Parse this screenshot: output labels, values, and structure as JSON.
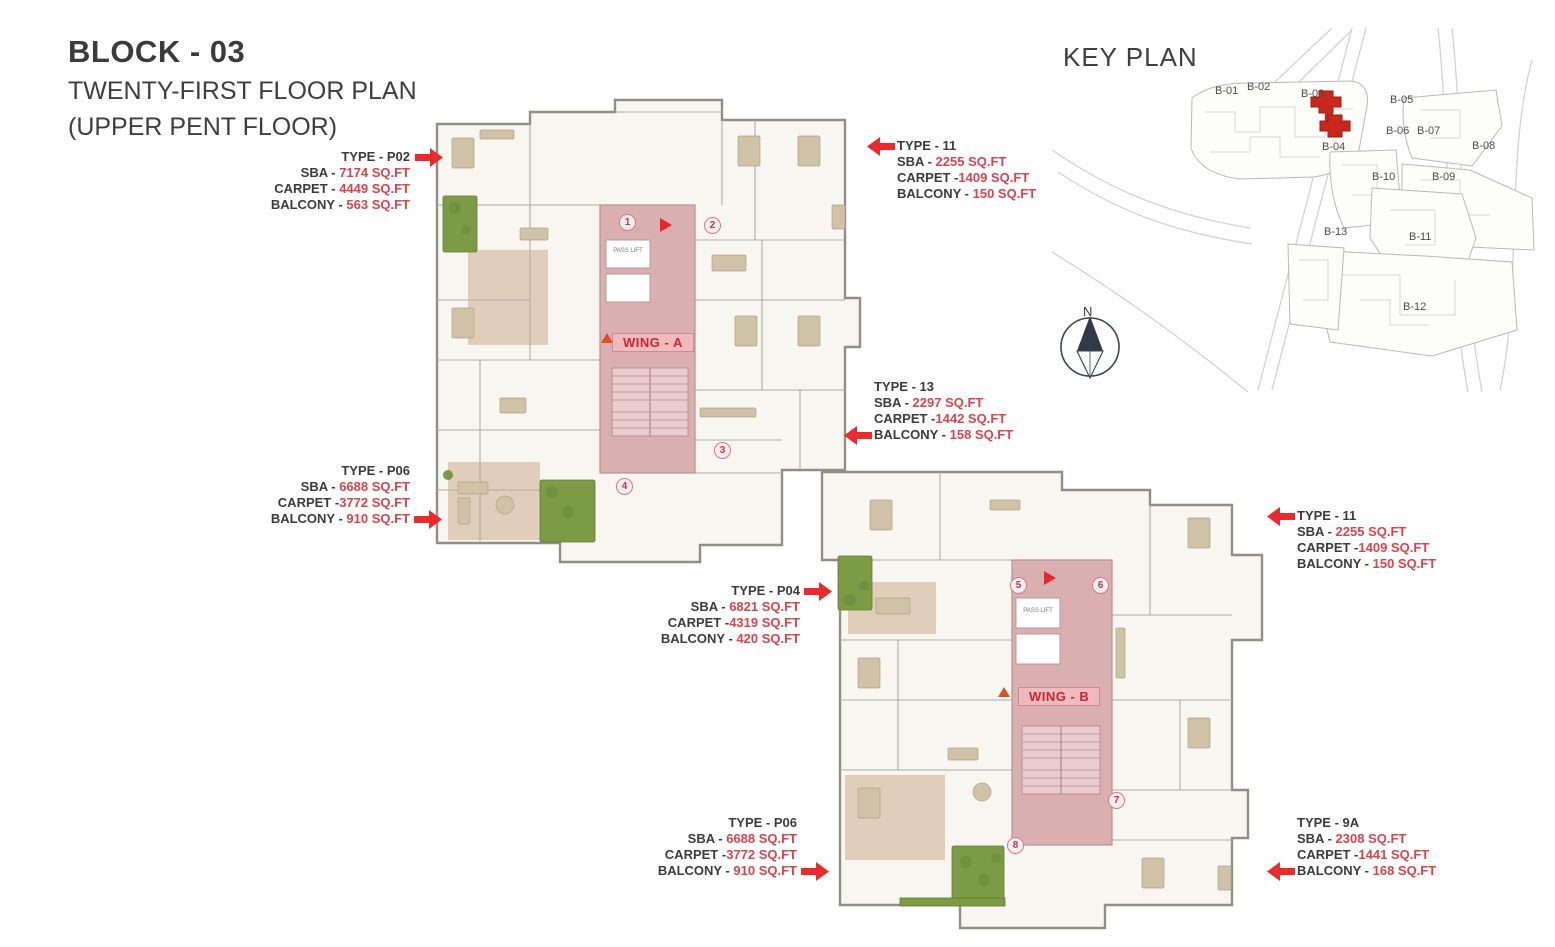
{
  "page_title": {
    "block": "BLOCK - 03",
    "plan": "TWENTY-FIRST FLOOR PLAN",
    "sub": "(UPPER PENT FLOOR)"
  },
  "key_plan": {
    "title": "KEY PLAN",
    "north_label": "N",
    "highlighted_block": "B-03",
    "blocks": [
      "B-01",
      "B-02",
      "B-03",
      "B-04",
      "B-05",
      "B-06",
      "B-07",
      "B-08",
      "B-09",
      "B-10",
      "B-11",
      "B-12",
      "B-13"
    ]
  },
  "wings": [
    {
      "label": "WING - A"
    },
    {
      "label": "WING - B"
    }
  ],
  "unit_markers": [
    "1",
    "2",
    "3",
    "4",
    "5",
    "6",
    "7",
    "8"
  ],
  "plan_labels": {
    "lift": "PASS LIFT"
  },
  "annotations": [
    {
      "name": "TYPE - P02",
      "arrow": "right",
      "rows": [
        {
          "label": "SBA - ",
          "value": "7174 SQ.FT"
        },
        {
          "label": "CARPET - ",
          "value": "4449 SQ.FT"
        },
        {
          "label": "BALCONY - ",
          "value": "563 SQ.FT"
        }
      ]
    },
    {
      "name": "TYPE - 11",
      "arrow": "left",
      "rows": [
        {
          "label": "SBA - ",
          "value": "2255 SQ.FT"
        },
        {
          "label": "CARPET -",
          "value": "1409 SQ.FT"
        },
        {
          "label": "BALCONY - ",
          "value": "150 SQ.FT"
        }
      ]
    },
    {
      "name": "TYPE - 13",
      "arrow": "left",
      "rows": [
        {
          "label": "SBA - ",
          "value": "2297 SQ.FT"
        },
        {
          "label": "CARPET -",
          "value": "1442 SQ.FT"
        },
        {
          "label": "BALCONY - ",
          "value": "158 SQ.FT"
        }
      ]
    },
    {
      "name": "TYPE - P06",
      "arrow": "right",
      "rows": [
        {
          "label": "SBA - ",
          "value": "6688 SQ.FT"
        },
        {
          "label": "CARPET -",
          "value": "3772 SQ.FT"
        },
        {
          "label": "BALCONY - ",
          "value": "910 SQ.FT"
        }
      ]
    },
    {
      "name": "TYPE - 11",
      "arrow": "left",
      "rows": [
        {
          "label": "SBA - ",
          "value": "2255 SQ.FT"
        },
        {
          "label": "CARPET -",
          "value": "1409 SQ.FT"
        },
        {
          "label": "BALCONY - ",
          "value": "150 SQ.FT"
        }
      ]
    },
    {
      "name": "TYPE - P04",
      "arrow": "right",
      "rows": [
        {
          "label": "SBA - ",
          "value": "6821 SQ.FT"
        },
        {
          "label": "CARPET -",
          "value": "4319 SQ.FT"
        },
        {
          "label": "BALCONY - ",
          "value": "420 SQ.FT"
        }
      ]
    },
    {
      "name": "TYPE - P06",
      "arrow": "right",
      "rows": [
        {
          "label": "SBA - ",
          "value": "6688 SQ.FT"
        },
        {
          "label": "CARPET -",
          "value": "3772 SQ.FT"
        },
        {
          "label": "BALCONY - ",
          "value": "910 SQ.FT"
        }
      ]
    },
    {
      "name": "TYPE - 9A",
      "arrow": "left",
      "rows": [
        {
          "label": "SBA - ",
          "value": "2308 SQ.FT"
        },
        {
          "label": "CARPET -",
          "value": "1441 SQ.FT"
        },
        {
          "label": "BALCONY - ",
          "value": "168 SQ.FT"
        }
      ]
    }
  ],
  "colors": {
    "accent_red": "#ea2b2e",
    "value_red": "#d9444b",
    "corridor_pink": "#d9b0af",
    "wing_chip_pink": "#eebabd",
    "plan_green": "#7d9b44",
    "text_dark": "#3b3b3b",
    "keyplan_highlight": "#c8281c"
  }
}
